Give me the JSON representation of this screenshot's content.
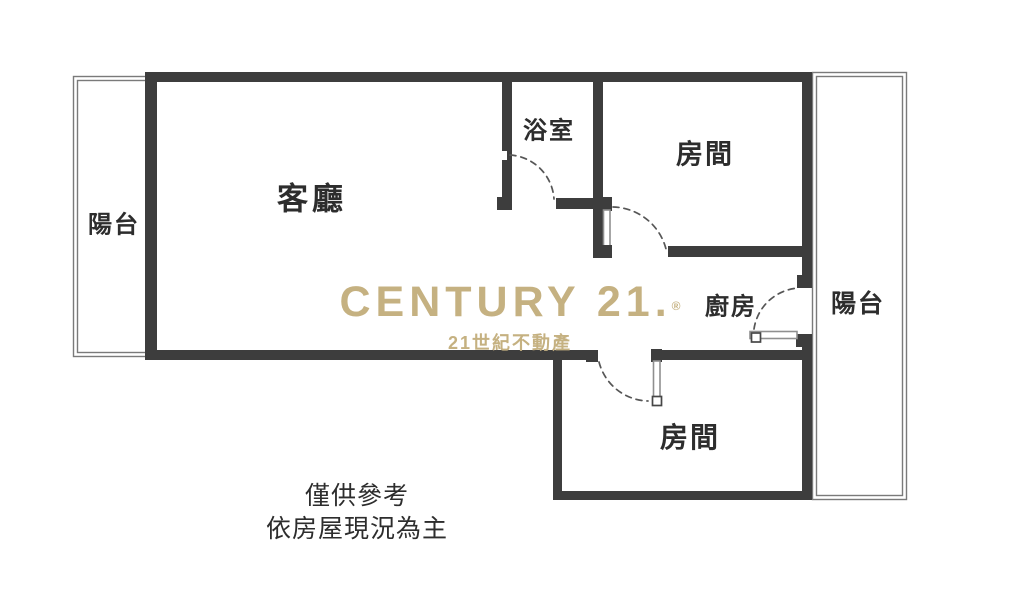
{
  "floorplan": {
    "labels": {
      "balcony_left": "陽台",
      "living_room": "客廳",
      "bathroom": "浴室",
      "bedroom_top": "房間",
      "kitchen": "廚房",
      "balcony_right": "陽台",
      "bedroom_bottom": "房間"
    },
    "watermark": {
      "brand": "CENTURY 21.",
      "registered_mark": "®",
      "subtitle": "21世紀不動產"
    },
    "disclaimer": {
      "line1": "僅供參考",
      "line2": "依房屋現況為主"
    },
    "colors": {
      "wall": "#3d3d3d",
      "thin_line": "#7a7a7a",
      "door_arc": "#565656",
      "label_text": "#2d2d2d",
      "watermark_gold": "#c5b181"
    }
  }
}
